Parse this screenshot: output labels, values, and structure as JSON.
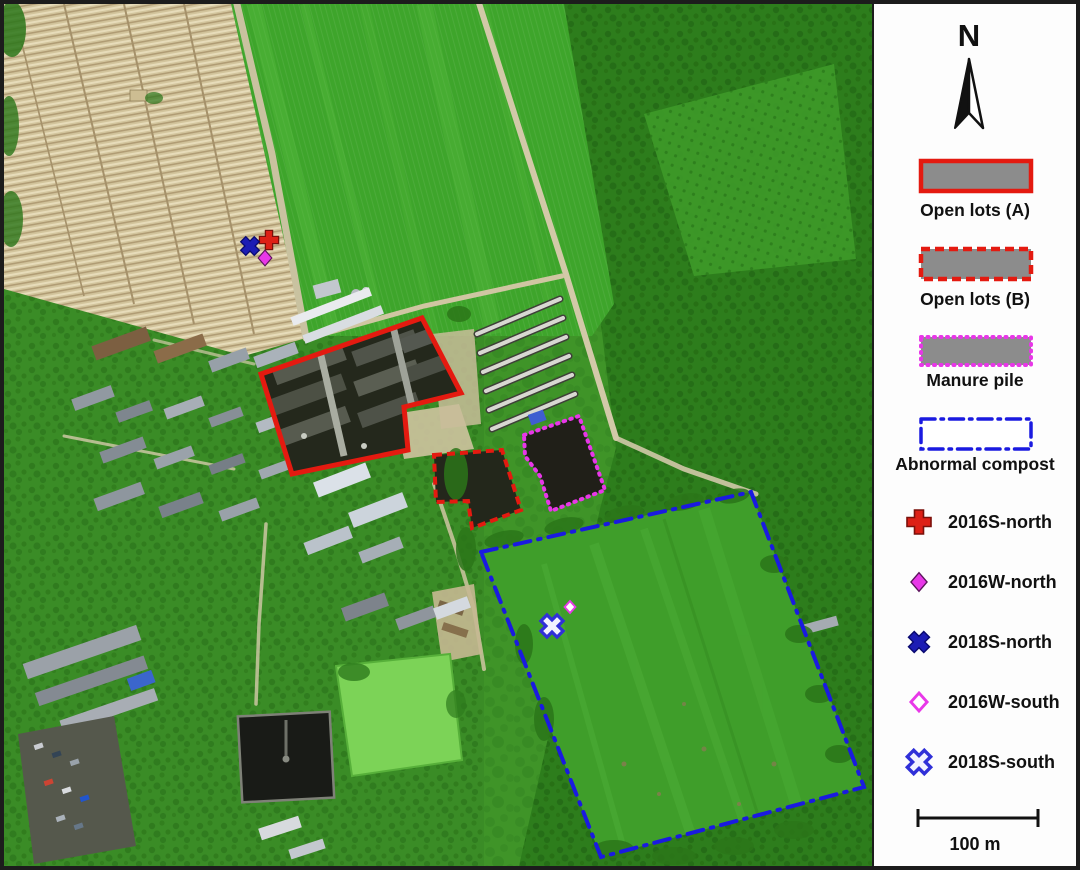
{
  "legend": {
    "north_label": "N",
    "zones": [
      {
        "id": "open-lots-a",
        "label": "Open lots (A)",
        "border": "solid-red"
      },
      {
        "id": "open-lots-b",
        "label": "Open lots (B)",
        "border": "dashed-red"
      },
      {
        "id": "manure-pile",
        "label": "Manure pile",
        "border": "dotted-magenta"
      },
      {
        "id": "abnormal-compost",
        "label": "Abnormal compost",
        "border": "dashdot-blue"
      }
    ],
    "markers": [
      {
        "id": "2016s-north",
        "label": "2016S-north",
        "symbol": "red-cross",
        "filled": true
      },
      {
        "id": "2016w-north",
        "label": "2016W-north",
        "symbol": "magenta-diamond",
        "filled": true
      },
      {
        "id": "2018s-north",
        "label": "2018S-north",
        "symbol": "blue-x",
        "filled": true
      },
      {
        "id": "2016w-south",
        "label": "2016W-south",
        "symbol": "magenta-diamond-open",
        "filled": false
      },
      {
        "id": "2018s-south",
        "label": "2018S-south",
        "symbol": "blue-x-open",
        "filled": false
      }
    ],
    "scale_label": "100 m"
  },
  "colors": {
    "open_lots": "#e41a10",
    "manure": "#e836e8",
    "compost": "#1a1ae0",
    "cross_red": "#dd2016",
    "cross_red_dark": "#7a100a",
    "diamond_magenta": "#e838e8",
    "diamond_dark": "#5c145c",
    "x_navy": "#1c1cb4",
    "x_navy_dark": "#0a0a70",
    "x_blue_open": "#3030d8",
    "swatch_gray": "#8c8c8c",
    "swatch_white": "#ffffff"
  },
  "map": {
    "zones": {
      "open_lots_a": {
        "points": "418,314 457,389 400,403 404,446 288,470 257,370"
      },
      "open_lots_b": {
        "points": "430,451 498,446 517,506 468,524 464,497 432,498"
      },
      "manure_pile": {
        "points": "520,431 575,412 601,486 547,507 536,472 521,452"
      },
      "abnormal_compost": {
        "points": "477,548 747,488 860,783 597,853"
      }
    },
    "markers": [
      {
        "id": "2016s-north",
        "transform": "translate(265,236) scale(0.8)"
      },
      {
        "id": "2016w-north",
        "transform": "translate(261,254) scale(0.72)"
      },
      {
        "id": "2018s-north",
        "transform": "translate(246,242) scale(0.8)"
      },
      {
        "id": "2016w-south",
        "transform": "translate(566,603) scale(0.6)"
      },
      {
        "id": "2018s-south",
        "transform": "translate(548,622) scale(0.95)"
      }
    ]
  }
}
